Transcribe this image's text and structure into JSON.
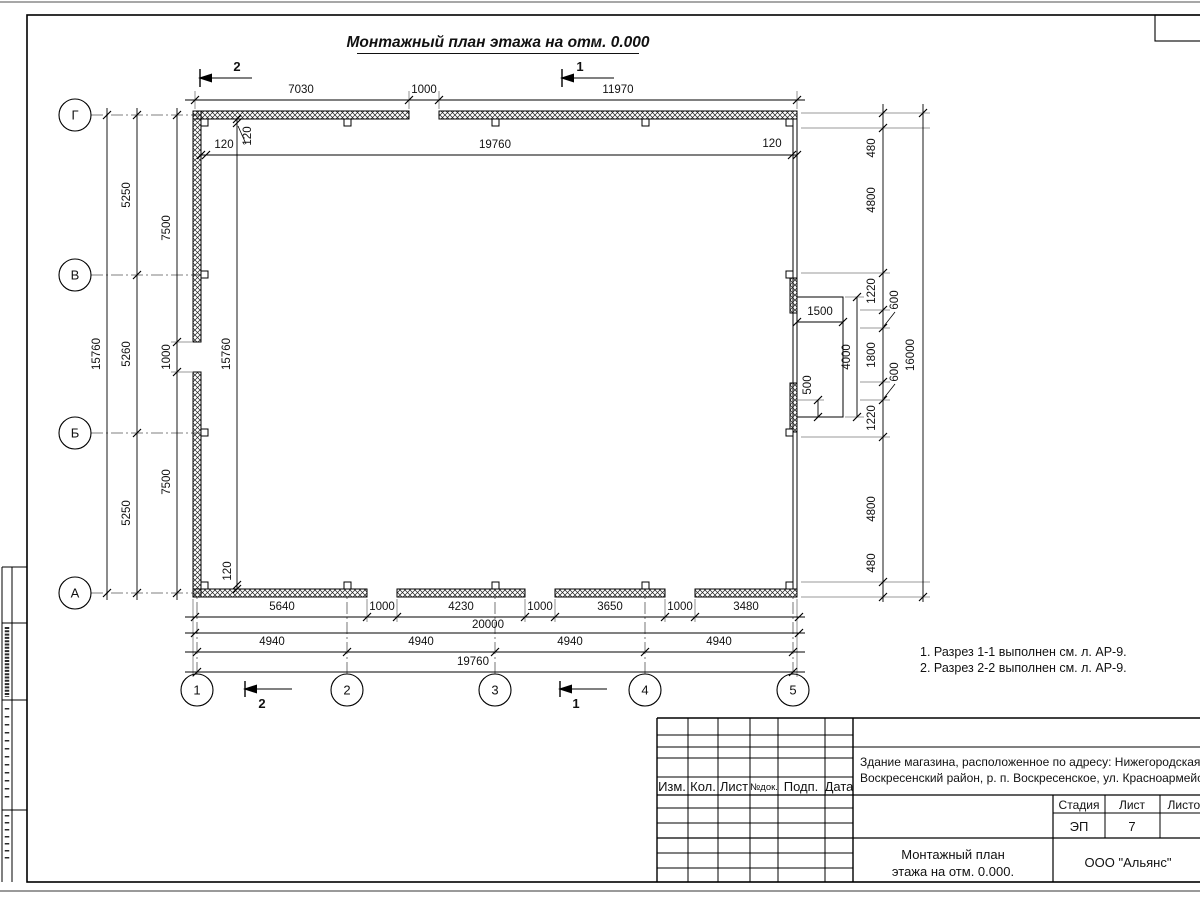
{
  "drawing_title": "Монтажный план этажа на отм. 0.000",
  "axes": {
    "cols": [
      "1",
      "2",
      "3",
      "4",
      "5"
    ],
    "rows": [
      "Г",
      "В",
      "Б",
      "А"
    ]
  },
  "section_marks": {
    "one": "1",
    "two": "2"
  },
  "dims": {
    "top": [
      "7030",
      "1000",
      "11970"
    ],
    "top_inner": [
      "120",
      "19760",
      "120"
    ],
    "left_total": "15760",
    "left_axes": [
      "5250",
      "5260",
      "5250"
    ],
    "left_wall": [
      "7500",
      "1000",
      "7500"
    ],
    "left_inner": [
      "120",
      "15760",
      "120"
    ],
    "right_chain": [
      "480",
      "4800",
      "1220",
      "600",
      "1800",
      "600",
      "1220",
      "4800",
      "480"
    ],
    "right_total": "16000",
    "bay": [
      "1500",
      "4000",
      "500"
    ],
    "bottom_wall": [
      "5640",
      "1000",
      "4230",
      "1000",
      "3650",
      "1000",
      "3480"
    ],
    "bottom_total": "20000",
    "bottom_axes": [
      "4940",
      "4940",
      "4940",
      "4940"
    ],
    "bottom_inner": "19760"
  },
  "notes": [
    "1. Разрез 1-1 выполнен см. л. АР-9.",
    "2. Разрез 2-2 выполнен см. л. АР-9."
  ],
  "title_block": {
    "cols": [
      "Изм.",
      "Кол.",
      "Лист",
      "№док.",
      "Подп.",
      "Дата"
    ],
    "project_line1": "Здание магазина, расположенное по адресу: Нижегородская область,",
    "project_line2": "Воскресенский район, р. п. Воскресенское, ул. Красноармейская, д. 1",
    "stage_label": "Стадия",
    "sheet_label": "Лист",
    "sheets_label": "Листов",
    "stage_value": "ЭП",
    "sheet_value": "7",
    "sheets_value": "",
    "doc_line1": "Монтажный план",
    "doc_line2": "этажа на отм. 0.000.",
    "company": "ООО \"Альянс\""
  }
}
